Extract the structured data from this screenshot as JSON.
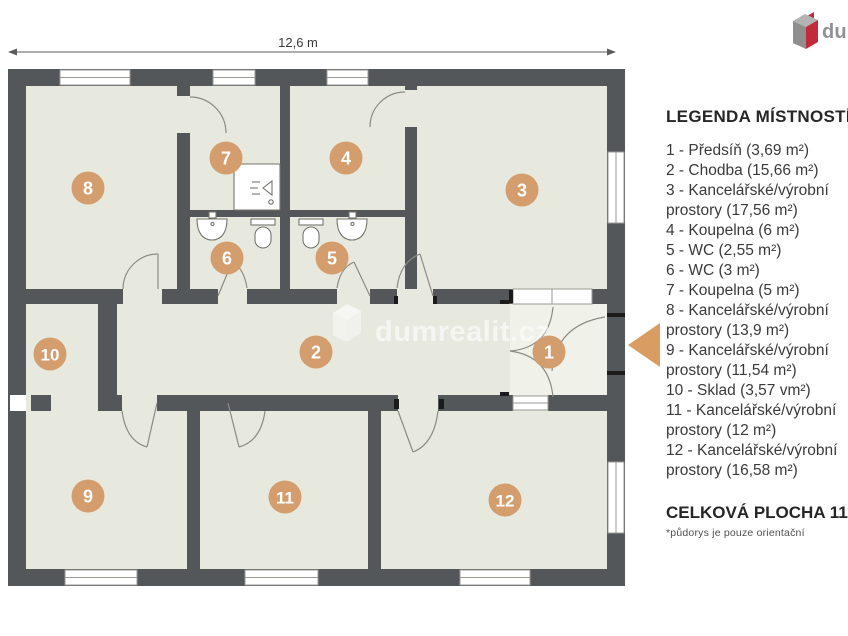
{
  "brand": {
    "logo_text": "dumrealit.cz",
    "logo_icon": "dumrealit-cube-icon",
    "logo_gray": "#909195",
    "logo_red": "#c2293a"
  },
  "dimension": {
    "label": "12,6 m"
  },
  "watermark": {
    "text": "dumrealit.cz",
    "icon": "dumrealit-cube-icon"
  },
  "plan": {
    "badges": [
      "1",
      "2",
      "3",
      "4",
      "5",
      "6",
      "7",
      "8",
      "9",
      "10",
      "11",
      "12"
    ],
    "colors": {
      "wall": "#54575a",
      "floor": "#e8e9de",
      "badge": "#d49d6d",
      "entry_arrow": "#d99c63"
    }
  },
  "legend": {
    "title": "LEGENDA MÍSTNOSTÍ:",
    "items": [
      "1 - Předsíň (3,69 m²)",
      "2 - Chodba (15,66 m²)",
      "3 - Kancelářské/výrobní\nprostory (17,56 m²)",
      "4 - Koupelna (6 m²)",
      "5 - WC (2,55 m²)",
      "6 - WC (3 m²)",
      "7 - Koupelna (5 m²)",
      "8 - Kancelářské/výrobní\nprostory (13,9 m²)",
      "9 - Kancelářské/výrobní\nprostory (11,54 m²)",
      "10 - Sklad (3,57 vm²)",
      "11 - Kancelářské/výrobní\nprostory (12 m²)",
      "12 - Kancelářské/výrobní\nprostory (16,58 m²)"
    ],
    "total": "CELKOVÁ PLOCHA 111,05 m²",
    "footnote": "*půdorys je pouze orientační"
  }
}
